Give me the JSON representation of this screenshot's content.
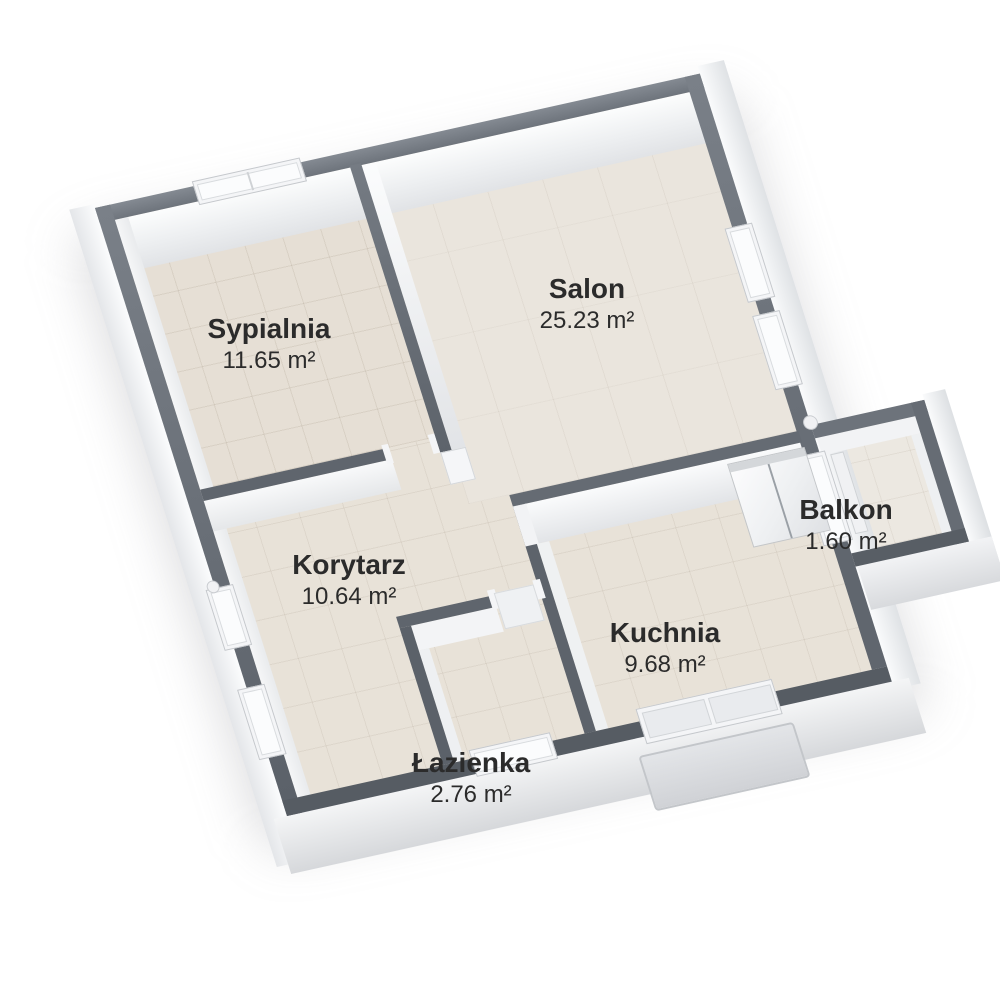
{
  "rooms": [
    {
      "id": "sypialnia",
      "name": "Sypialnia",
      "area": "11.65 m²"
    },
    {
      "id": "salon",
      "name": "Salon",
      "area": "25.23 m²"
    },
    {
      "id": "korytarz",
      "name": "Korytarz",
      "area": "10.64 m²"
    },
    {
      "id": "balkon",
      "name": "Balkon",
      "area": "1.60 m²"
    },
    {
      "id": "kuchnia",
      "name": "Kuchnia",
      "area": "9.68 m²"
    },
    {
      "id": "lazienka",
      "name": "Łazienka",
      "area": "2.76 m²"
    }
  ],
  "colors": {
    "wall_top": "#666c74",
    "wall_face": "#f2f3f5",
    "floor": "#e8e2d8",
    "label_text": "#2b2b2b",
    "background": "#ffffff"
  }
}
